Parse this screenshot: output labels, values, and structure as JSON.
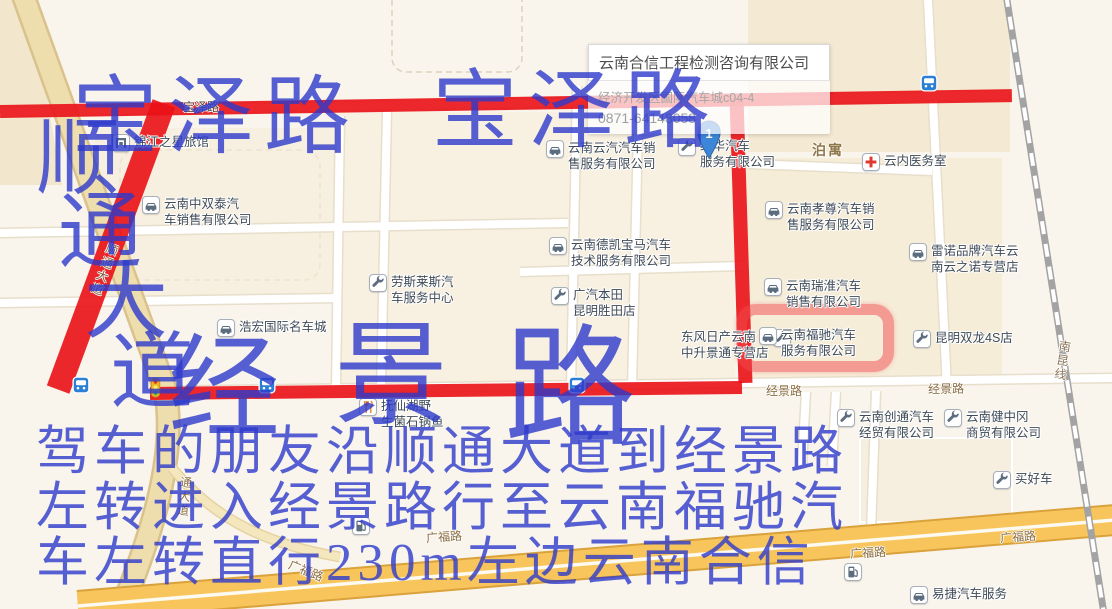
{
  "popup": {
    "title": "云南合信工程检测咨询有限公司",
    "address": "经济开发区国际汽车城c04-4",
    "phone": "0871-64148058"
  },
  "marker": {
    "label": "1"
  },
  "map": {
    "area_label": "泊寓",
    "road_labels": [
      {
        "id": "baoze-road-label",
        "text": "宝泽路",
        "x": 183,
        "y": 98,
        "rot": 0,
        "vertical": false,
        "color": "#5a453a"
      },
      {
        "id": "shuntong-road-label",
        "text": "顺通大道",
        "x": 96,
        "y": 242,
        "rot": 20,
        "vertical": true,
        "color": "#7c5f3f"
      },
      {
        "id": "shuntong-south-label",
        "text": "通大道",
        "x": 176,
        "y": 476,
        "rot": 6,
        "vertical": true,
        "color": "#8a6d42"
      },
      {
        "id": "jingjing-road-label-1",
        "text": "经景路",
        "x": 766,
        "y": 382,
        "rot": 0,
        "vertical": false,
        "color": "#8a6d42"
      },
      {
        "id": "jingjing-road-label-2",
        "text": "经景路",
        "x": 928,
        "y": 380,
        "rot": -1,
        "vertical": false,
        "color": "#8a6d42"
      },
      {
        "id": "guangfu-road-label-1",
        "text": "广福路",
        "x": 288,
        "y": 562,
        "rot": 22,
        "vertical": false,
        "color": "#8a6d42"
      },
      {
        "id": "guangfu-road-label-2",
        "text": "广福路",
        "x": 426,
        "y": 528,
        "rot": -4,
        "vertical": false,
        "color": "#8a6d42"
      },
      {
        "id": "guangfu-road-label-3",
        "text": "广福路",
        "x": 850,
        "y": 544,
        "rot": -3,
        "vertical": false,
        "color": "#8a6d42"
      },
      {
        "id": "guangfu-road-label-4",
        "text": "广福路",
        "x": 1000,
        "y": 528,
        "rot": -4,
        "vertical": false,
        "color": "#8a6d42"
      },
      {
        "id": "nankun-railway-label",
        "text": "南昆线",
        "x": 1054,
        "y": 340,
        "rot": 9,
        "vertical": true,
        "color": "#8b7355"
      }
    ],
    "pois": [
      {
        "id": "jinjiang-hotel",
        "icon": "hotel",
        "lines": [
          "锦江之星旅馆"
        ],
        "x": 112,
        "y": 134
      },
      {
        "id": "zhongshuangtai-auto",
        "icon": "car",
        "lines": [
          "云南中双泰汽",
          "车销售有限公司"
        ],
        "x": 142,
        "y": 196
      },
      {
        "id": "yunqi-auto",
        "icon": "car",
        "lines": [
          "云南云汽汽车销",
          "售服务有限公司"
        ],
        "x": 546,
        "y": 140
      },
      {
        "id": "jinghua-auto",
        "icon": "wrench",
        "lines": [
          "经华汽车",
          "服务有限公司"
        ],
        "x": 678,
        "y": 138
      },
      {
        "id": "yunnei-clinic",
        "icon": "cross",
        "lines": [
          "云内医务室"
        ],
        "x": 862,
        "y": 153
      },
      {
        "id": "xiaozun-auto",
        "icon": "car",
        "lines": [
          "云南孝尊汽车销",
          "售服务有限公司"
        ],
        "x": 765,
        "y": 201
      },
      {
        "id": "dekai-bmw",
        "icon": "car",
        "lines": [
          "云南德凯宝马汽车",
          "技术服务有限公司"
        ],
        "x": 549,
        "y": 237
      },
      {
        "id": "leinuo-renault",
        "icon": "car",
        "lines": [
          "雷诺品牌汽车云",
          "南云之诺专营店"
        ],
        "x": 909,
        "y": 243
      },
      {
        "id": "ruihuai-auto",
        "icon": "car",
        "lines": [
          "云南瑞淮汽车",
          "销售有限公司"
        ],
        "x": 764,
        "y": 278
      },
      {
        "id": "rolls-royce-center",
        "icon": "wrench",
        "lines": [
          "劳斯莱斯汽",
          "车服务中心"
        ],
        "x": 369,
        "y": 274
      },
      {
        "id": "gac-honda",
        "icon": "wrench",
        "lines": [
          "广汽本田",
          "昆明胜田店"
        ],
        "x": 551,
        "y": 287
      },
      {
        "id": "haohong-mall",
        "icon": "car",
        "lines": [
          "浩宏国际名车城"
        ],
        "x": 217,
        "y": 319
      },
      {
        "id": "dongfeng-nissan",
        "icon": "wrench",
        "lines": [
          "东风日产云南",
          "中升景通专营店"
        ],
        "x": 681,
        "y": 329,
        "side": "right"
      },
      {
        "id": "fuchi-auto",
        "icon": "car",
        "lines": [
          "云南福驰汽车",
          "服务有限公司"
        ],
        "x": 759,
        "y": 327
      },
      {
        "id": "shuanglong-4s",
        "icon": "wrench",
        "lines": [
          "昆明双龙4S店"
        ],
        "x": 913,
        "y": 330
      },
      {
        "id": "fuxianhu-restaurant",
        "icon": "fork",
        "lines": [
          "抚仙湖野",
          "生菌石锅鱼"
        ],
        "x": 359,
        "y": 398
      },
      {
        "id": "chuangtong-auto",
        "icon": "wrench",
        "lines": [
          "云南创通汽车",
          "经贸有限公司"
        ],
        "x": 837,
        "y": 409
      },
      {
        "id": "jianzhonggang-trade",
        "icon": "wrench",
        "lines": [
          "云南健中冈",
          "商贸有限公司"
        ],
        "x": 944,
        "y": 409
      },
      {
        "id": "maihaoche",
        "icon": "wrench",
        "lines": [
          "买好车"
        ],
        "x": 993,
        "y": 471
      },
      {
        "id": "yijie-service",
        "icon": "car",
        "lines": [
          "易捷汽车服务"
        ],
        "x": 910,
        "y": 586
      },
      {
        "id": "gas-station-1",
        "icon": "gas",
        "lines": [],
        "x": 352,
        "y": 517
      },
      {
        "id": "gas-station-2",
        "icon": "gas",
        "lines": [],
        "x": 844,
        "y": 563
      },
      {
        "id": "bus-stop-1",
        "icon": "bus",
        "lines": [],
        "x": 72,
        "y": 376
      },
      {
        "id": "bus-stop-2",
        "icon": "bus",
        "lines": [],
        "x": 258,
        "y": 376
      },
      {
        "id": "bus-stop-3",
        "icon": "bus",
        "lines": [],
        "x": 568,
        "y": 376
      },
      {
        "id": "bus-stop-4",
        "icon": "bus",
        "lines": [],
        "x": 920,
        "y": 74
      },
      {
        "id": "traffic-light-1",
        "icon": "light",
        "lines": [],
        "x": 150,
        "y": 377
      }
    ]
  },
  "annotations": {
    "route_color": "#ea1116",
    "text_color": "#2d3aca",
    "baoze_1": "宝泽路",
    "baoze_2": "宝泽路",
    "shuntong_chars": [
      "顺",
      "通",
      "大",
      "道"
    ],
    "jingjing_chars": [
      "经",
      "景",
      "路"
    ],
    "instructions": [
      "驾车的朋友沿顺通大道到经景路",
      "左转进入经景路行至云南福驰汽",
      "车左转直行230m左边云南合信"
    ]
  }
}
